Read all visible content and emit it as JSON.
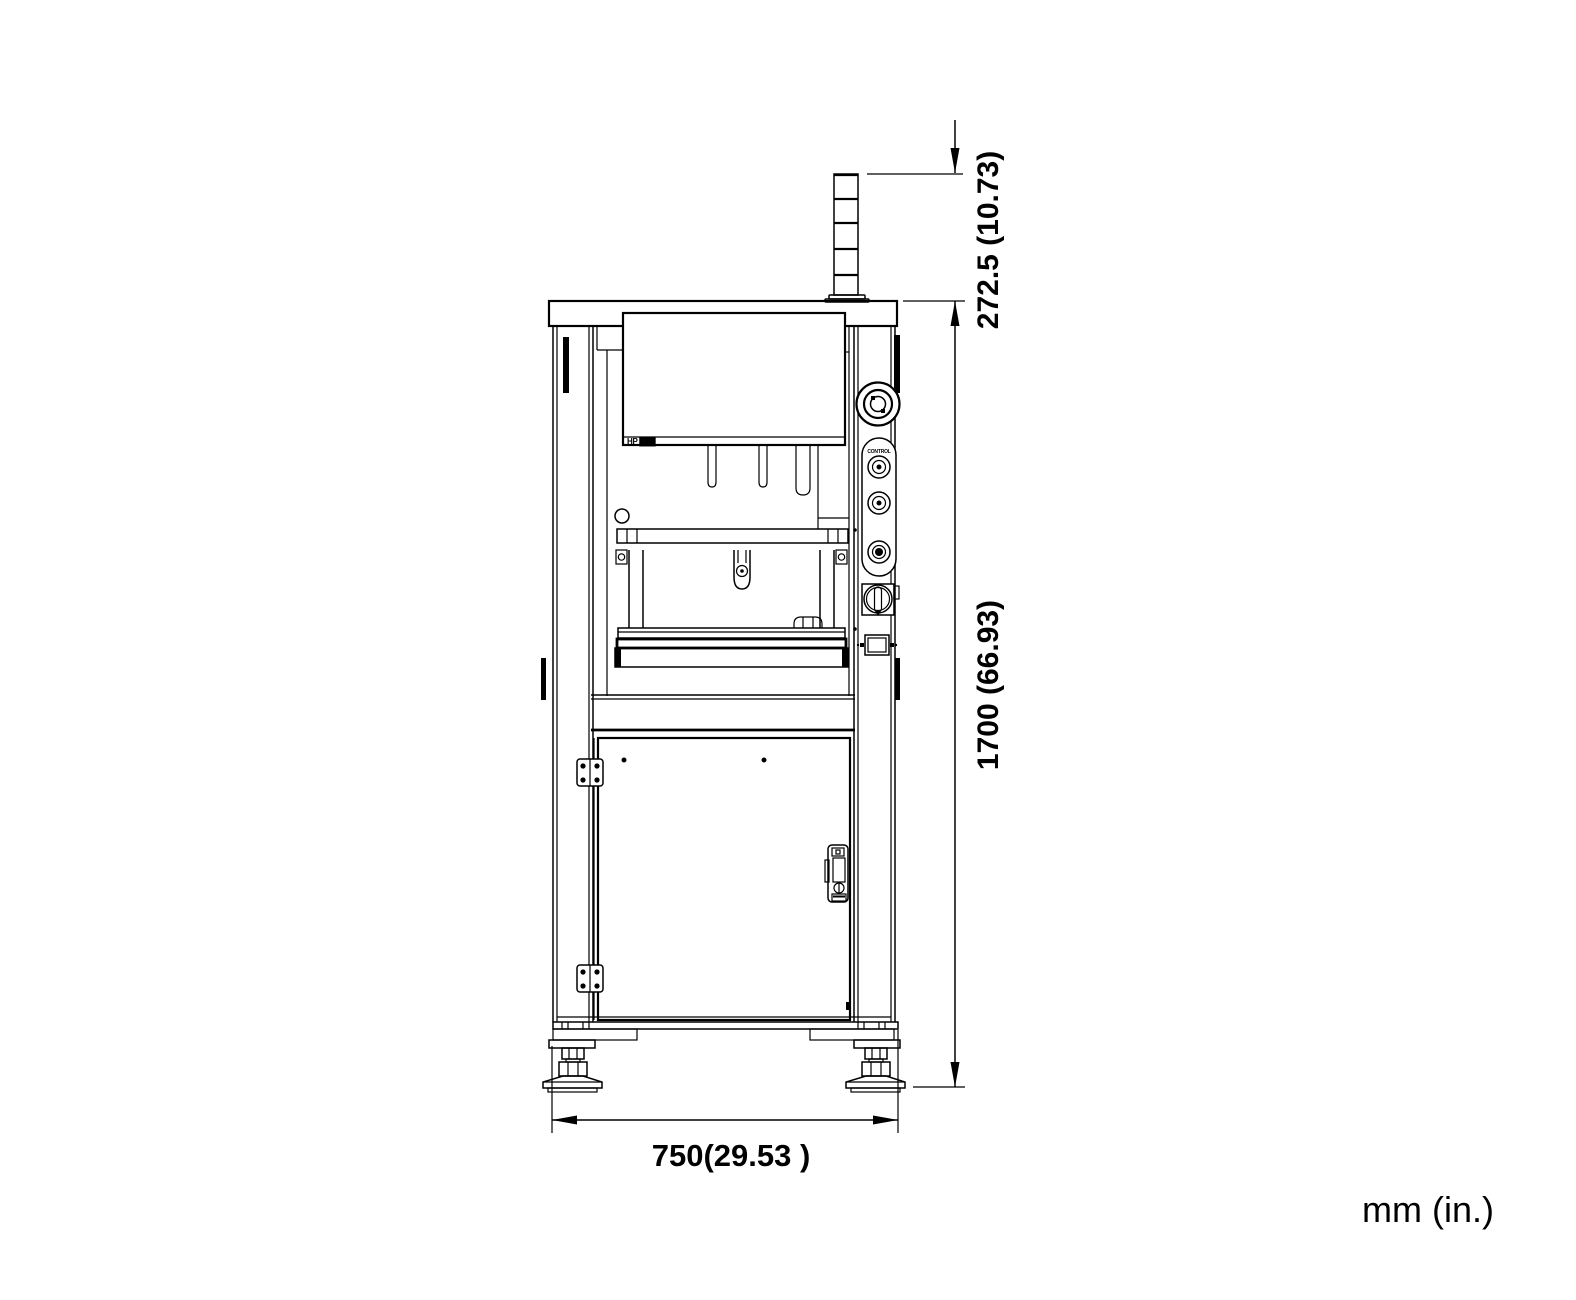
{
  "drawing": {
    "units_note": "mm (in.)",
    "dimensions": {
      "beacon_height": "272.5 (10.73)",
      "overall_height": "1700 (66.93)",
      "overall_width": "750(29.53 )"
    },
    "labels": {
      "panel_model": "HP ███",
      "control_pod": "CONTROL"
    },
    "colors": {
      "line": "#000000",
      "background": "#ffffff"
    }
  }
}
